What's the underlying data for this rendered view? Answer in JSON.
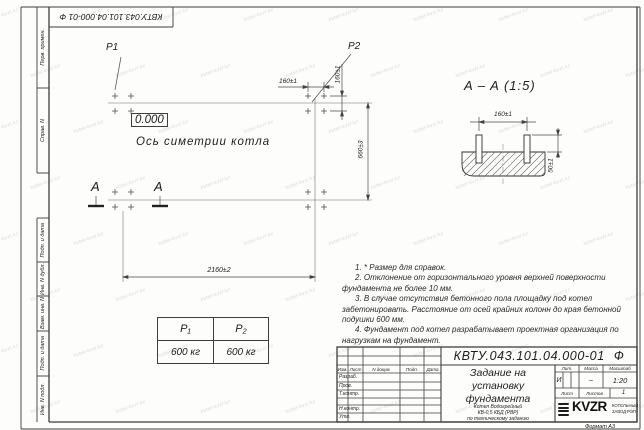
{
  "sheet": {
    "stamp_top": "КВТУ.043.101.04.000-01 Ф",
    "format_label": "Формат А3",
    "watermark_text": "kotel-kvzr.kz",
    "margin_labels_upper": [
      "Перв. примен.",
      "Справ. N"
    ],
    "margin_labels_lower": [
      "Подп. и дата",
      "Инв. N дубл.",
      "Взам. инв. N",
      "Подп. и дата",
      "Инв. N подл."
    ]
  },
  "plan_view": {
    "label_p1": "P1",
    "label_p2": "P2",
    "elevation_mark": "0.000",
    "axis_caption": "Ось симетрии котла",
    "section_mark_left": "A",
    "section_mark_right": "A",
    "dim_bolt_pitch_top": "160±1",
    "dim_bolt_pitch_side": "160±1",
    "dim_row_spacing": "660±3",
    "dim_overall_length": "2160±2"
  },
  "section_view": {
    "title": "A – A (1:5)",
    "dim_bolt_pitch": "160±1",
    "dim_bolt_height": "50±1"
  },
  "notes": {
    "items": [
      "1. * Размер для справок.",
      "2. Отклонение от горизонтального уровня верхней поверхности фундамента не более 10 мм.",
      "3. В случае отсутствия бетонного пола площадку под котел забетонировать. Расстояние от осей крайних колонн до края бетонной подушки 600 мм.",
      "4. Фундамент под котел разрабатывает проектная организация по нагрузкам на фундамент."
    ]
  },
  "load_table": {
    "col1_header": "P₁",
    "col2_header": "P₂",
    "col1_value": "600 кг",
    "col2_value": "600 кг"
  },
  "title_block": {
    "doc_number": "КВТУ.043.101.04.000-01 Ф",
    "col_izm": "Изм.",
    "col_list": "Лист",
    "col_doc": "N докум.",
    "col_sign": "Подп.",
    "col_date": "Дата",
    "row_razrab": "Разраб.",
    "row_prov": "Пров.",
    "row_tkontr": "Т.контр.",
    "row_nkontr": "Н.контр.",
    "row_utv": "Утв.",
    "title_line1": "Задание на",
    "title_line2": "установку",
    "title_line3": "фундамента",
    "subtitle_line1": "Котел Водогрейный",
    "subtitle_line2": "КВ-0,5 КБД (РВР)",
    "subtitle_line3": "по техническому заданию",
    "lit_header": "Лит.",
    "lit_value": "И",
    "mass_header": "Масса",
    "mass_value": "–",
    "scale_header": "Масштаб",
    "scale_value": "1:20",
    "list_label": "Лист",
    "listov_label": "Листов",
    "listov_value": "1",
    "logo_text": "KVZR",
    "logo_caption1": "КОТЕЛЬНЫЙ",
    "logo_caption2": "ЗАВОД РЭП"
  }
}
